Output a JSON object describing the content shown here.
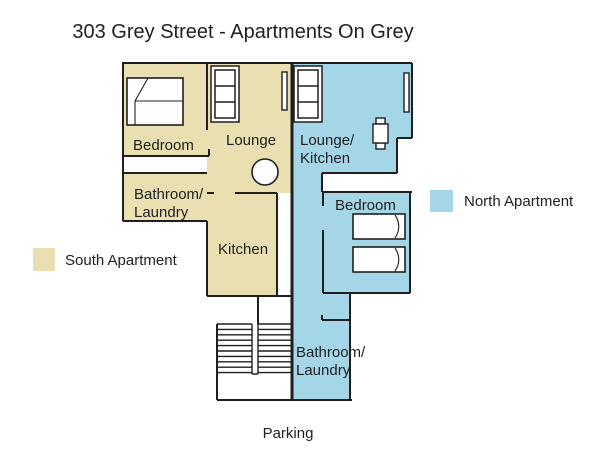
{
  "title": "303 Grey Street - Apartments On Grey",
  "colors": {
    "south_fill": "#e9dfb0",
    "north_fill": "#a5d6e8",
    "wall": "#1f1f1f",
    "text": "#1f1f1f",
    "background": "#ffffff"
  },
  "legend": {
    "south_label": "South Apartment",
    "north_label": "North Apartment"
  },
  "south_apartment": {
    "bedroom": "Bedroom",
    "lounge": "Lounge",
    "bathroom_line1": "Bathroom/",
    "bathroom_line2": "Laundry",
    "kitchen": "Kitchen"
  },
  "north_apartment": {
    "lounge_line1": "Lounge/",
    "lounge_line2": "Kitchen",
    "bedroom": "Bedroom",
    "bathroom_line1": "Bathroom/",
    "bathroom_line2": "Laundry"
  },
  "outside": {
    "parking": "Parking"
  },
  "furniture": {
    "south_bed": "double-bed",
    "south_sofa": "sofa",
    "south_round_table": "round-table",
    "south_entry_door": "open-door",
    "north_sofa": "sofa",
    "north_window": "window",
    "north_table": "small-table-with-chairs",
    "north_bed_1": "single-bed",
    "north_bed_2": "single-bed",
    "stairs": "staircase"
  }
}
